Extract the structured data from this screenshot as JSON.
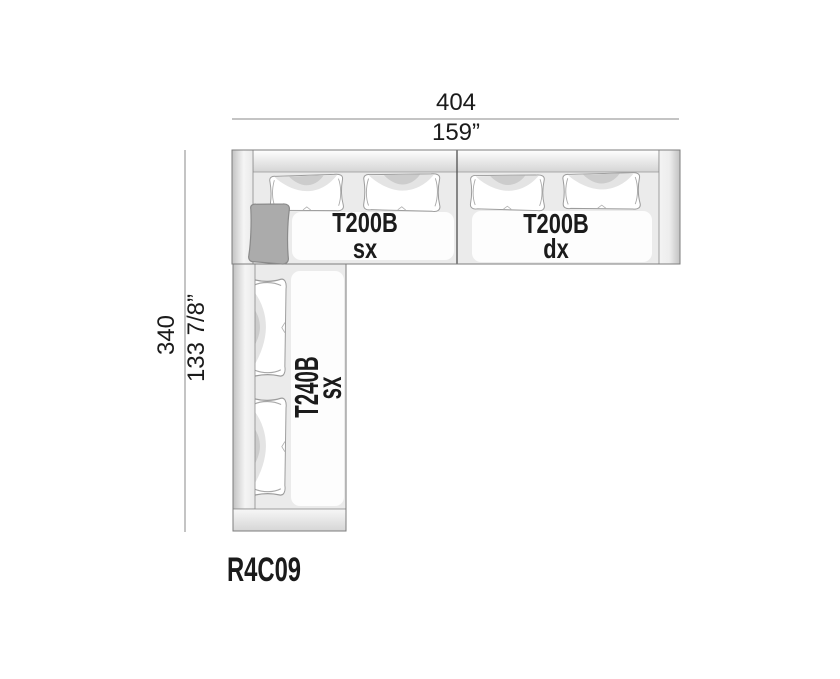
{
  "product": {
    "code": "R4C09"
  },
  "dimensions": {
    "width_cm": "404",
    "width_inches": "159”",
    "depth_cm": "340",
    "depth_inches": "133 7/8”"
  },
  "modules": [
    {
      "code": "T200B",
      "variant": "sx"
    },
    {
      "code": "T200B",
      "variant": "dx"
    },
    {
      "code": "T240B",
      "variant": "sx"
    }
  ],
  "colors": {
    "outline": "#7d7d7d",
    "seam": "#9c9c9c",
    "separator": "#4f4f4f",
    "dimension_line": "#8a8a8a",
    "module_fill": "#ebebeb",
    "cushion_fill": "#ffffff",
    "accent_cushion_fill": "#ababab",
    "text": "#1b1b1b"
  }
}
